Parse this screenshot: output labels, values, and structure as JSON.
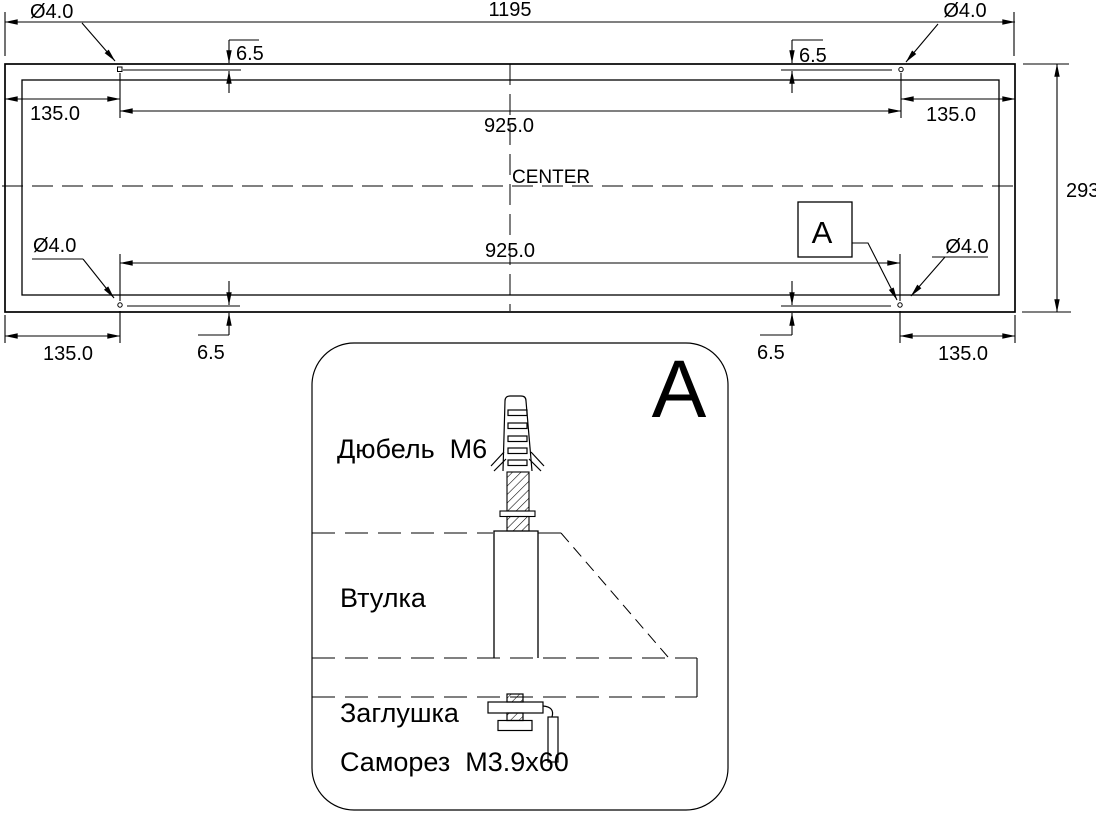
{
  "colors": {
    "background": "#ffffff",
    "line": "#000000"
  },
  "main_view": {
    "overall_width": "1195",
    "overall_height": "293",
    "center_label": "CENTER",
    "hole_diameter": {
      "top_left": "Ø4.0",
      "top_right": "Ø4.0",
      "bottom_left": "Ø4.0",
      "bottom_right": "Ø4.0"
    },
    "hole_spacing": {
      "top": "925.0",
      "bottom": "925.0"
    },
    "edge_offset": {
      "top_left": "135.0",
      "top_right": "135.0",
      "bottom_left": "135.0",
      "bottom_right": "135.0"
    },
    "vertical_offset": {
      "top_left": "6.5",
      "top_right": "6.5",
      "bottom_left": "6.5",
      "bottom_right": "6.5"
    },
    "detail_callout": "A"
  },
  "detail_view": {
    "title": "A",
    "parts": {
      "dowel": "Дюбель  M6",
      "sleeve": "Втулка",
      "plug": "Заглушка",
      "screw": "Саморез  M3.9x60"
    }
  }
}
